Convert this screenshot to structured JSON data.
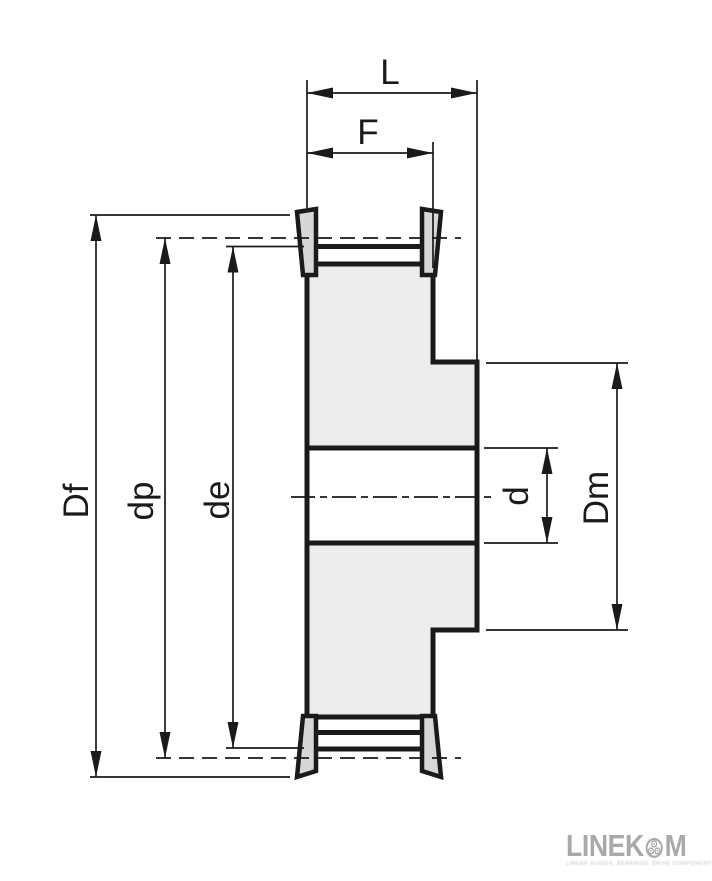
{
  "drawing": {
    "type": "technical-drawing",
    "subject": "timing-belt-pulley-cross-section",
    "labels": {
      "L": "L",
      "F": "F",
      "Df": "Df",
      "dp": "dp",
      "de": "de",
      "d": "d",
      "Dm": "Dm"
    },
    "colors": {
      "line": "#1a1a1a",
      "body_fill": "#ececec",
      "flange_fill": "#d7d7d7",
      "background": "#ffffff"
    }
  },
  "logo": {
    "text_before_icon": "LINEK",
    "text_after_icon": "M",
    "icon": "roller-bearing-icon",
    "tagline": "LINEAR GUIDES, BEARINGS, DRIVE COMPONENTS",
    "color": "#a9a9a9"
  }
}
